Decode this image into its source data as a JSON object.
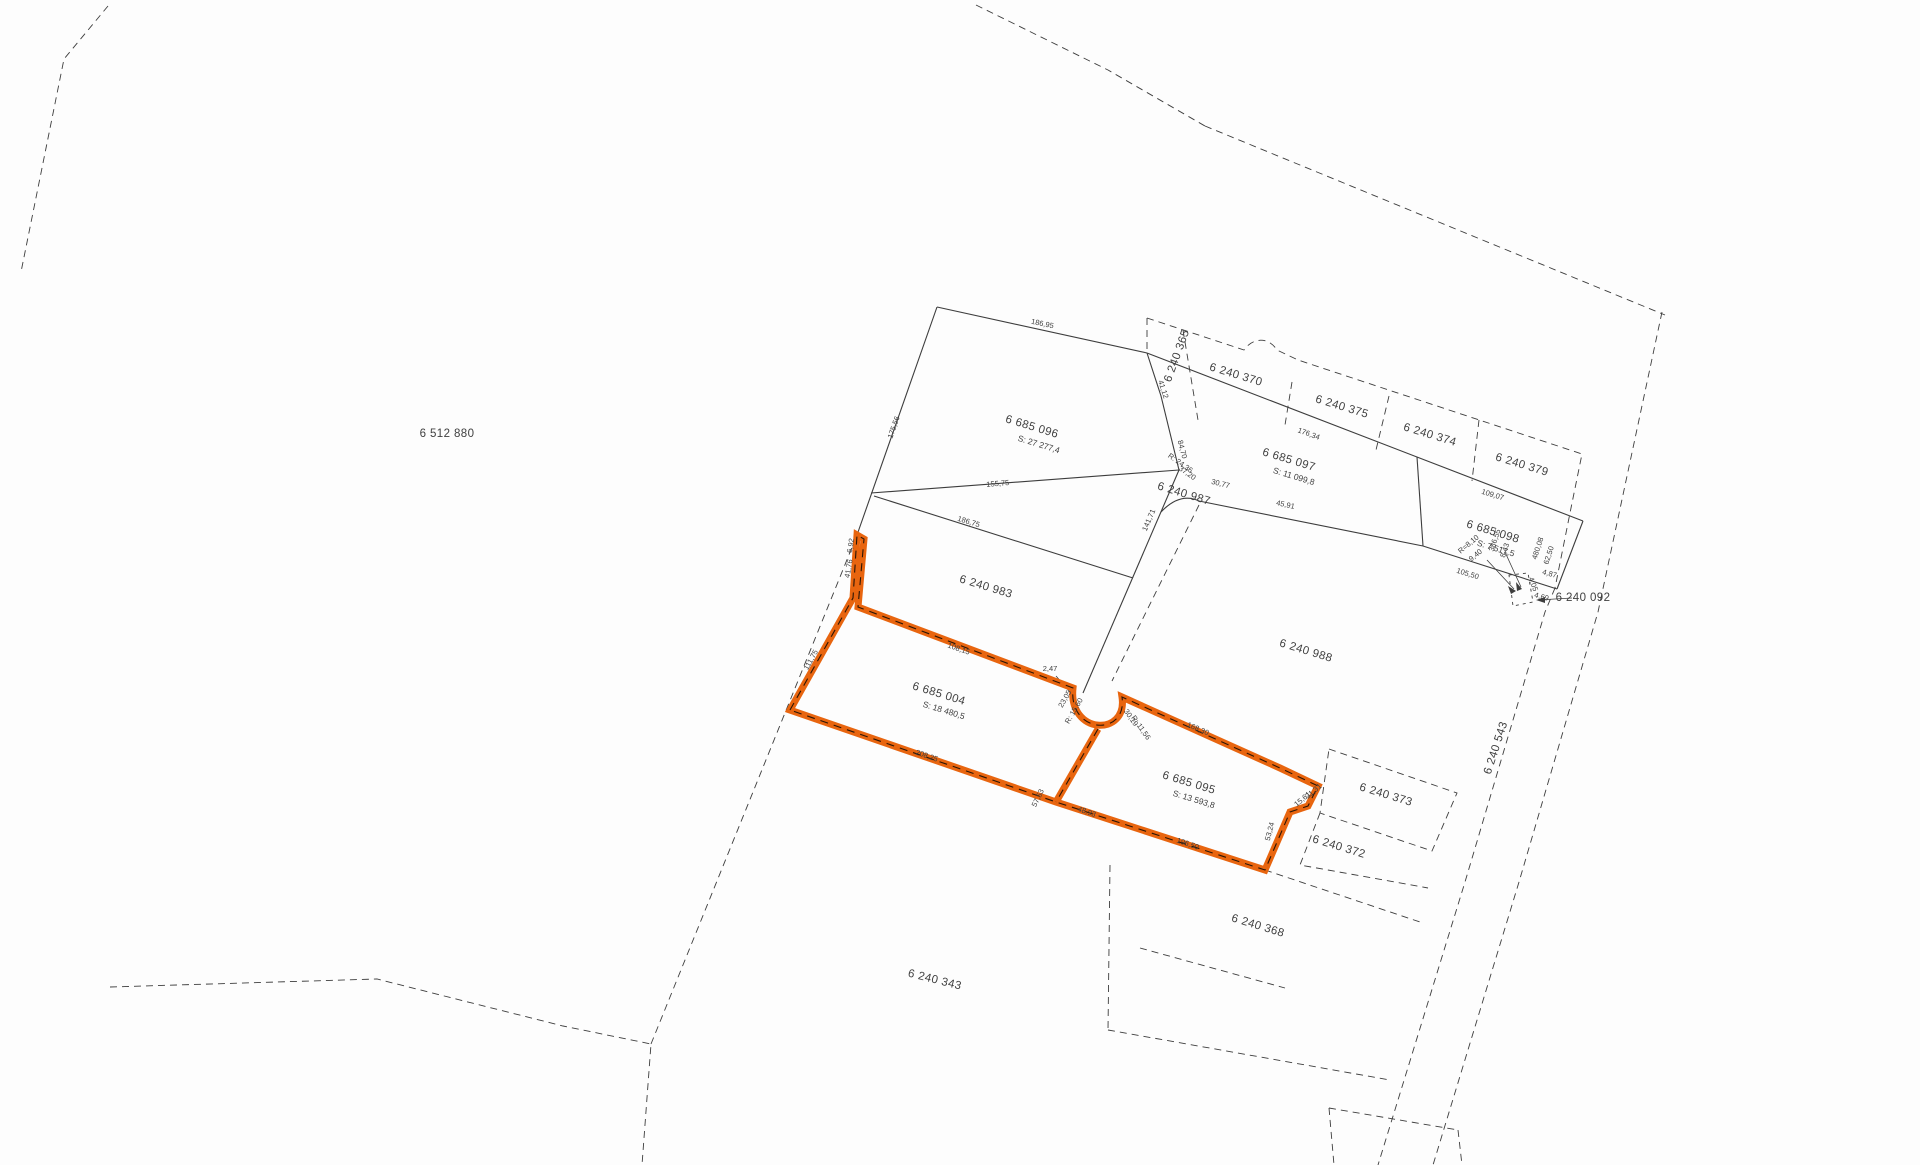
{
  "map": {
    "type": "cadastral-parcel-map",
    "background": "#fdfdfd",
    "line_color": "#3d3d3d",
    "text_color": "#3f3f3f",
    "highlight_color": "#e8650f",
    "highlight_centerline_color": "#2a1506",
    "highlighted_parcels": [
      "6 685 004",
      "6 685 095"
    ],
    "labels": [
      {
        "t": "6 685 096",
        "x": 1031,
        "y": 430,
        "r": 17,
        "c": "p"
      },
      {
        "t": "S: 27 277,4",
        "x": 1038,
        "y": 447,
        "r": 17,
        "c": "a"
      },
      {
        "t": "6 685 097",
        "x": 1288,
        "y": 463,
        "r": 17,
        "c": "p"
      },
      {
        "t": "S: 11 099,8",
        "x": 1293,
        "y": 479,
        "r": 17,
        "c": "a"
      },
      {
        "t": "6 685 098",
        "x": 1492,
        "y": 535,
        "r": 17,
        "c": "p"
      },
      {
        "t": "S: 7 517,5",
        "x": 1495,
        "y": 551,
        "r": 17,
        "c": "a"
      },
      {
        "t": "6 685 004",
        "x": 938,
        "y": 697,
        "r": 17,
        "c": "p"
      },
      {
        "t": "S: 18 480,5",
        "x": 943,
        "y": 713,
        "r": 17,
        "c": "a"
      },
      {
        "t": "6 685 095",
        "x": 1188,
        "y": 786,
        "r": 17,
        "c": "p"
      },
      {
        "t": "S: 13 593,8",
        "x": 1193,
        "y": 802,
        "r": 17,
        "c": "a"
      },
      {
        "t": "6 240 983",
        "x": 985,
        "y": 590,
        "r": 17,
        "c": "p"
      },
      {
        "t": "6 240 987",
        "x": 1183,
        "y": 497,
        "r": 17,
        "c": "p"
      },
      {
        "t": "6 240 988",
        "x": 1305,
        "y": 654,
        "r": 17,
        "c": "p"
      },
      {
        "t": "6 240 365",
        "x": 1180,
        "y": 357,
        "r": -70,
        "c": "p"
      },
      {
        "t": "6 240 370",
        "x": 1235,
        "y": 378,
        "r": 17,
        "c": "p"
      },
      {
        "t": "6 240 375",
        "x": 1341,
        "y": 410,
        "r": 17,
        "c": "p"
      },
      {
        "t": "6 240 374",
        "x": 1429,
        "y": 438,
        "r": 17,
        "c": "p"
      },
      {
        "t": "6 240 379",
        "x": 1521,
        "y": 468,
        "r": 17,
        "c": "p"
      },
      {
        "t": "6 240 373",
        "x": 1385,
        "y": 798,
        "r": 17,
        "c": "p"
      },
      {
        "t": "6 240 372",
        "x": 1338,
        "y": 850,
        "r": 17,
        "c": "p"
      },
      {
        "t": "6 240 368",
        "x": 1257,
        "y": 929,
        "r": 17,
        "c": "p"
      },
      {
        "t": "6 240 343",
        "x": 934,
        "y": 983,
        "r": 14,
        "c": "p"
      },
      {
        "t": "6 240 543",
        "x": 1499,
        "y": 749,
        "r": -72,
        "c": "p"
      },
      {
        "t": "6 240 092",
        "x": 1583,
        "y": 601,
        "r": 0,
        "c": "p"
      },
      {
        "t": "6 512 880",
        "x": 447,
        "y": 437,
        "r": 0,
        "c": "p"
      },
      {
        "t": "186,95",
        "x": 1042,
        "y": 326,
        "r": 12,
        "c": "m"
      },
      {
        "t": "175,56",
        "x": 896,
        "y": 428,
        "r": -71,
        "c": "m"
      },
      {
        "t": "41,12",
        "x": 1161,
        "y": 390,
        "r": 72,
        "c": "m"
      },
      {
        "t": "155,75",
        "x": 998,
        "y": 486,
        "r": -5,
        "c": "m"
      },
      {
        "t": "186,75",
        "x": 968,
        "y": 524,
        "r": 17,
        "c": "m"
      },
      {
        "t": "176,34",
        "x": 1308,
        "y": 436,
        "r": 20,
        "c": "m"
      },
      {
        "t": "109,07",
        "x": 1492,
        "y": 497,
        "r": 17,
        "c": "m"
      },
      {
        "t": "45,91",
        "x": 1285,
        "y": 507,
        "r": 12,
        "c": "m"
      },
      {
        "t": "30,77",
        "x": 1220,
        "y": 486,
        "r": 14,
        "c": "m"
      },
      {
        "t": "R: 24,36",
        "x": 1179,
        "y": 465,
        "r": 35,
        "c": "m"
      },
      {
        "t": "37,20",
        "x": 1186,
        "y": 475,
        "r": 35,
        "c": "m"
      },
      {
        "t": "84,70",
        "x": 1180,
        "y": 450,
        "r": 75,
        "c": "m"
      },
      {
        "t": "141,71",
        "x": 1151,
        "y": 521,
        "r": -67,
        "c": "m"
      },
      {
        "t": "105,50",
        "x": 1467,
        "y": 576,
        "r": 17,
        "c": "m"
      },
      {
        "t": "480,08",
        "x": 1540,
        "y": 549,
        "r": -72,
        "c": "m"
      },
      {
        "t": "62,50",
        "x": 1551,
        "y": 556,
        "r": -72,
        "c": "m"
      },
      {
        "t": "R=8,10",
        "x": 1470,
        "y": 546,
        "r": -40,
        "c": "m"
      },
      {
        "t": "9,40",
        "x": 1477,
        "y": 557,
        "r": -40,
        "c": "m"
      },
      {
        "t": "386,55",
        "x": 1497,
        "y": 541,
        "r": -72,
        "c": "m"
      },
      {
        "t": "8,43",
        "x": 1507,
        "y": 551,
        "r": -72,
        "c": "m"
      },
      {
        "t": "4,87",
        "x": 1549,
        "y": 576,
        "r": 15,
        "c": "m"
      },
      {
        "t": "4,05",
        "x": 1531,
        "y": 585,
        "r": 70,
        "c": "m"
      },
      {
        "t": "4,69",
        "x": 1541,
        "y": 599,
        "r": 15,
        "c": "m"
      },
      {
        "t": "6,92",
        "x": 853,
        "y": 546,
        "r": -80,
        "c": "m"
      },
      {
        "t": "41,76",
        "x": 851,
        "y": 569,
        "r": -80,
        "c": "m"
      },
      {
        "t": "111,75",
        "x": 813,
        "y": 661,
        "r": -61,
        "c": "m"
      },
      {
        "t": "208,25",
        "x": 926,
        "y": 758,
        "r": 19,
        "c": "m"
      },
      {
        "t": "108,15",
        "x": 958,
        "y": 651,
        "r": 19,
        "c": "m"
      },
      {
        "t": "57,53",
        "x": 1040,
        "y": 799,
        "r": -64,
        "c": "m"
      },
      {
        "t": "48,93",
        "x": 1086,
        "y": 814,
        "r": 19,
        "c": "m"
      },
      {
        "t": "196,50",
        "x": 1187,
        "y": 846,
        "r": 19,
        "c": "m"
      },
      {
        "t": "168,30",
        "x": 1197,
        "y": 731,
        "r": 23,
        "c": "m"
      },
      {
        "t": "53,24",
        "x": 1272,
        "y": 832,
        "r": -75,
        "c": "m"
      },
      {
        "t": "15,61",
        "x": 1304,
        "y": 801,
        "r": -40,
        "c": "m"
      },
      {
        "t": "21,31",
        "x": 1315,
        "y": 793,
        "r": -40,
        "c": "m"
      },
      {
        "t": "23,05",
        "x": 1067,
        "y": 700,
        "r": -60,
        "c": "m"
      },
      {
        "t": "R: 15,60",
        "x": 1076,
        "y": 712,
        "r": -60,
        "c": "m"
      },
      {
        "t": "30,19",
        "x": 1129,
        "y": 719,
        "r": 55,
        "c": "m"
      },
      {
        "t": "R: 11,56",
        "x": 1139,
        "y": 729,
        "r": 55,
        "c": "m"
      },
      {
        "t": "2,47",
        "x": 1050,
        "y": 671,
        "r": 0,
        "c": "m"
      }
    ]
  }
}
